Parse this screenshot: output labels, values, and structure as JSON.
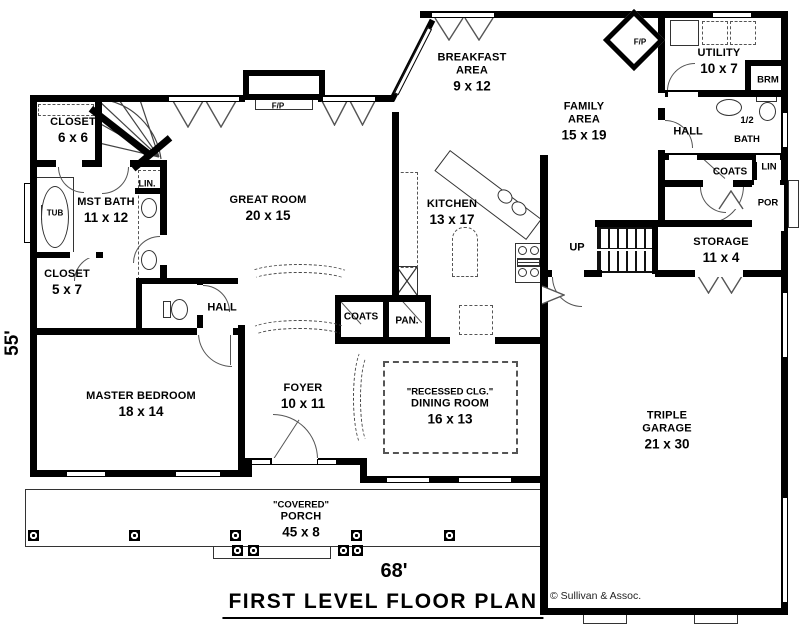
{
  "title_block": {
    "plan_title": "FIRST LEVEL FLOOR PLAN",
    "width_dimension": "68'",
    "height_dimension": "55'",
    "copyright": "© Sullivan & Assoc."
  },
  "rooms": {
    "closet_upper": {
      "name": "CLOSET",
      "dims": "6 x 6"
    },
    "mst_bath": {
      "name": "MST BATH",
      "dims": "11 x 12"
    },
    "closet_lower": {
      "name": "CLOSET",
      "dims": "5 x 7"
    },
    "great_room": {
      "name": "GREAT ROOM",
      "dims": "20 x 15"
    },
    "breakfast_area": {
      "name": "BREAKFAST\nAREA",
      "dims": "9 x 12"
    },
    "family_area": {
      "name": "FAMILY\nAREA",
      "dims": "15 x 19"
    },
    "utility": {
      "name": "UTILITY",
      "dims": "10 x 7"
    },
    "kitchen": {
      "name": "KITCHEN",
      "dims": "13 x 17"
    },
    "storage": {
      "name": "STORAGE",
      "dims": "11 x 4"
    },
    "dining_room": {
      "note": "\"RECESSED CLG.\"",
      "name": "DINING ROOM",
      "dims": "16 x 13"
    },
    "master_bedroom": {
      "name": "MASTER BEDROOM",
      "dims": "18 x 14"
    },
    "foyer": {
      "name": "FOYER",
      "dims": "10 x 11"
    },
    "garage": {
      "name": "TRIPLE\nGARAGE",
      "dims": "21 x 30"
    },
    "porch": {
      "note": "\"COVERED\"",
      "name": "PORCH",
      "dims": "45 x 8"
    }
  },
  "labels": {
    "hall_left": "HALL",
    "hall_right": "HALL",
    "coats_left": "COATS",
    "coats_right": "COATS",
    "pantry": "PAN.",
    "linen_left": "LIN.",
    "linen_right": "LIN",
    "broom": "BRM",
    "half_bath": "1/2\nBATH",
    "rear_porch": "POR",
    "tub": "TUB",
    "stairs_up": "UP",
    "fireplace_great": "F/P",
    "fireplace_family": "F/P"
  },
  "colors": {
    "wall": "#000000",
    "background": "#ffffff",
    "thin_line": "#444444"
  }
}
